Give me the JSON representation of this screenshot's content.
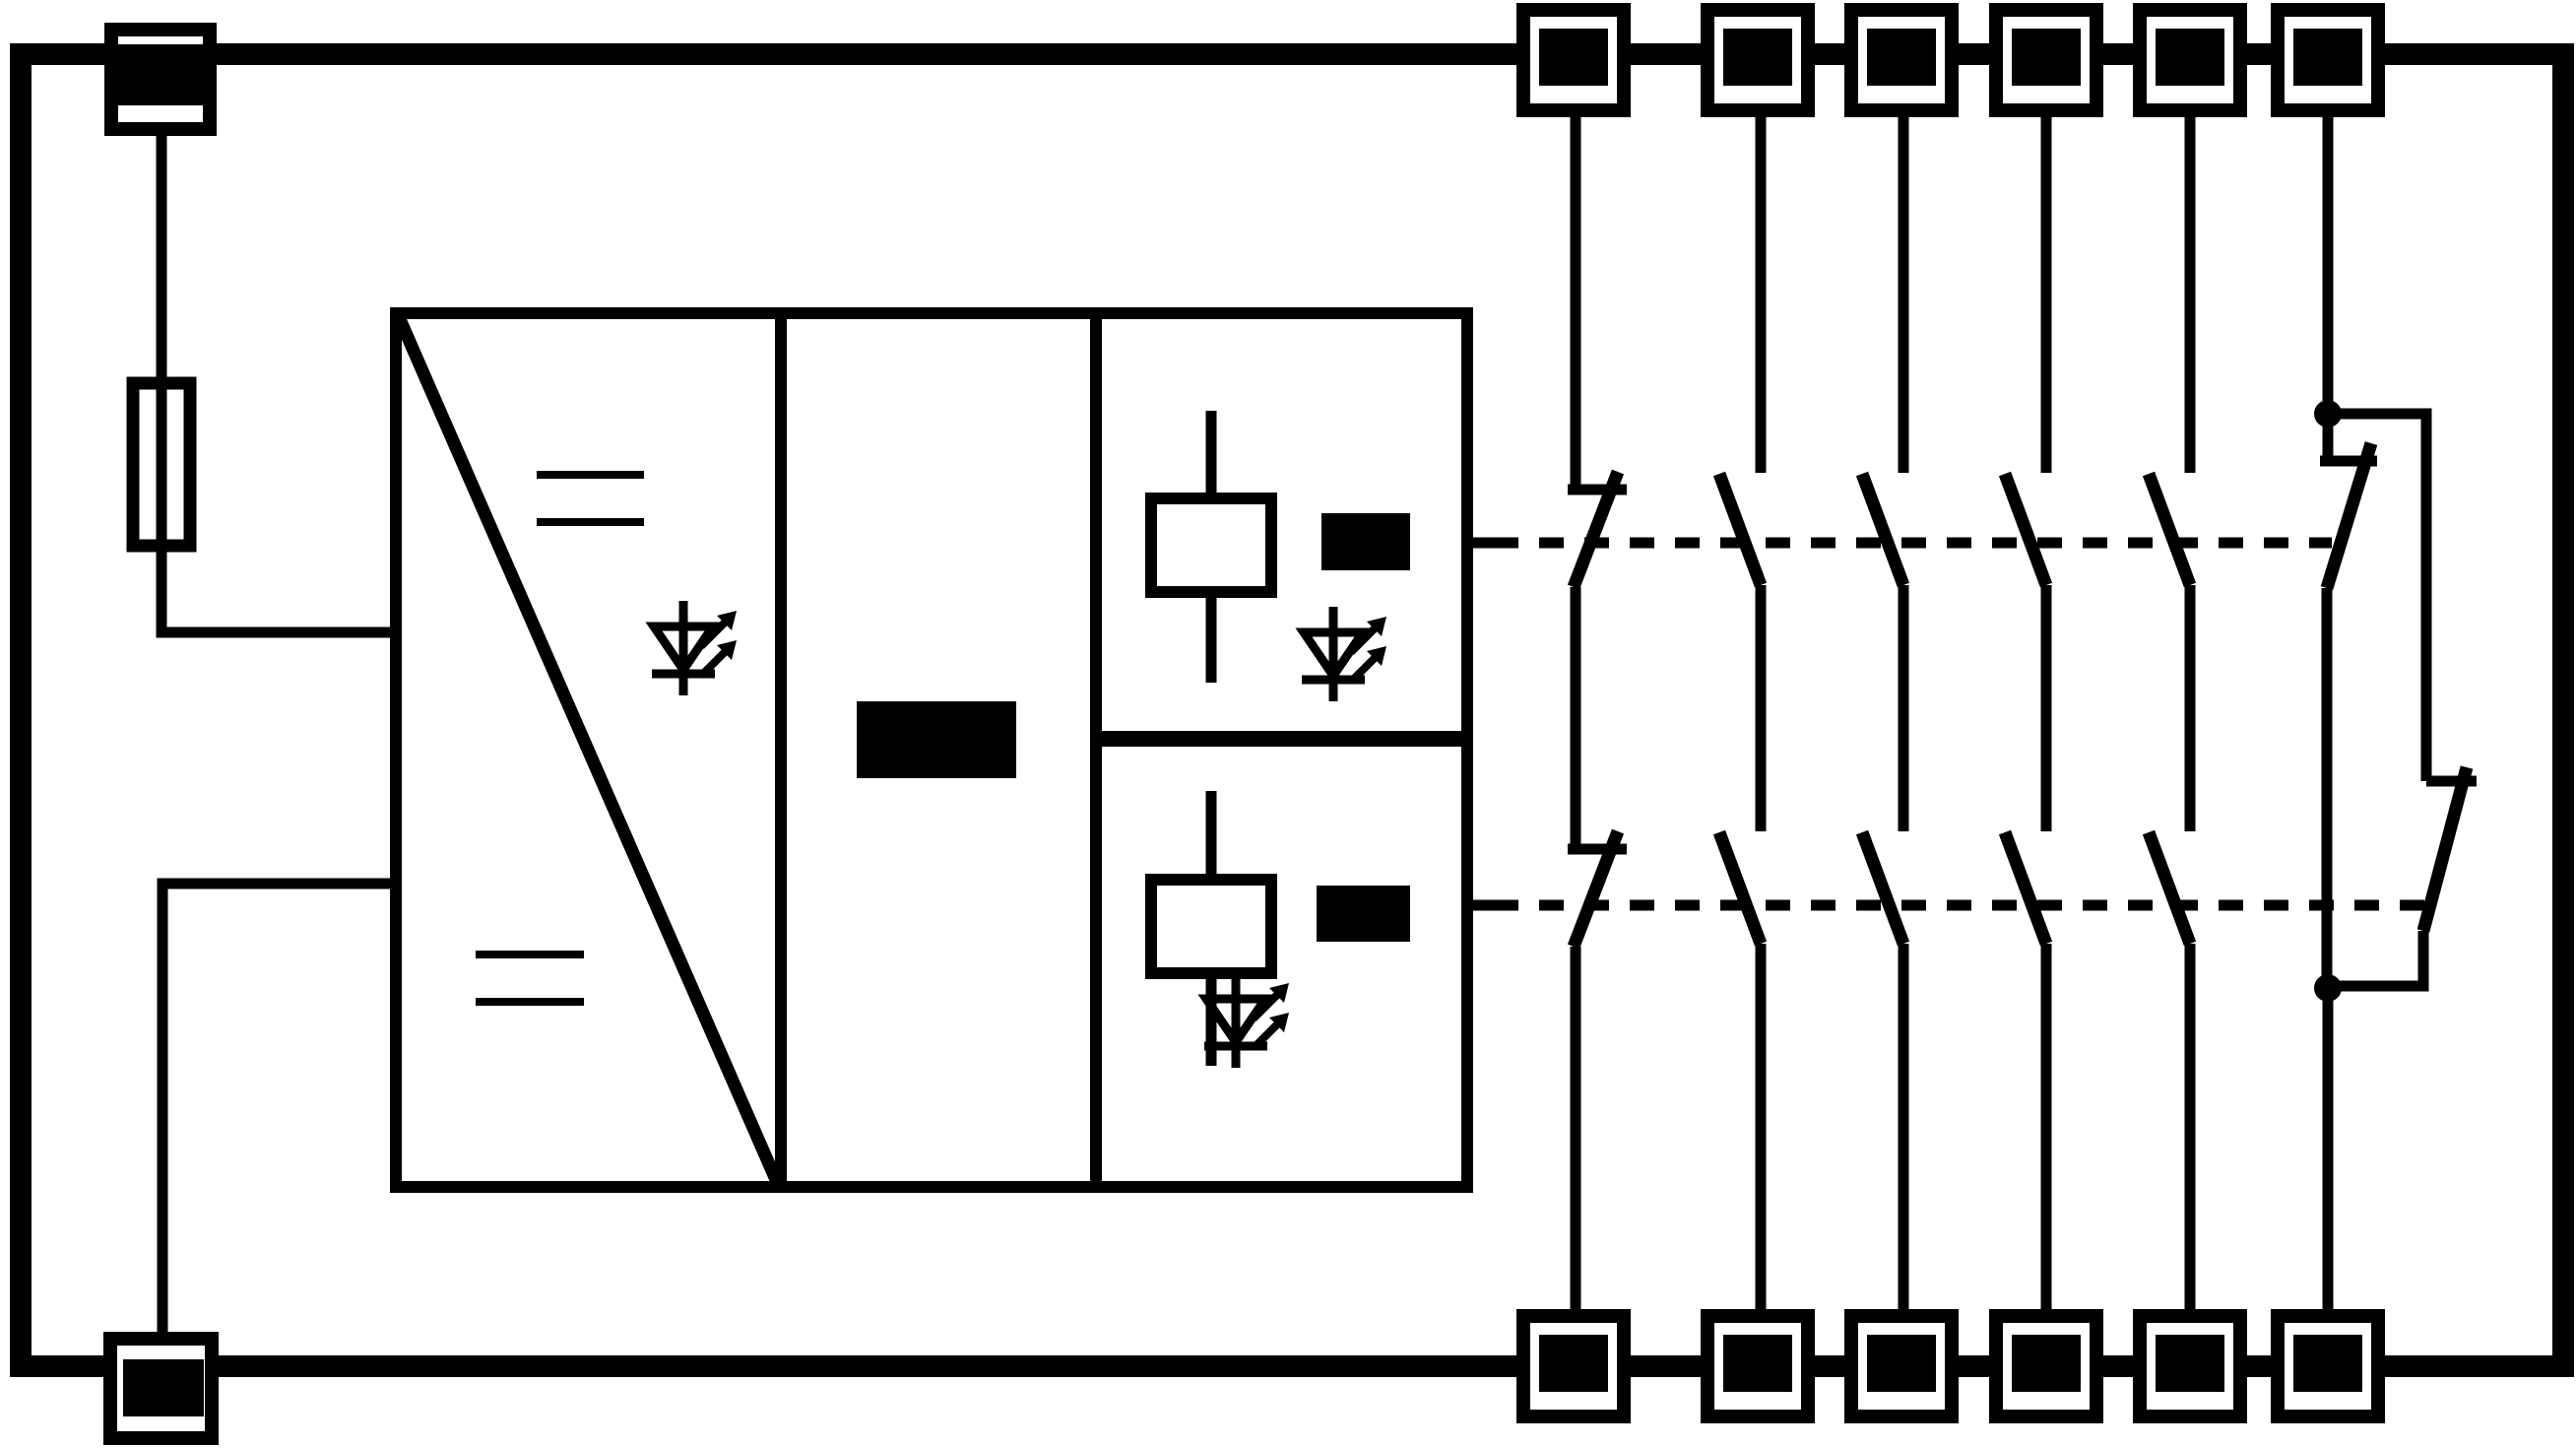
{
  "app": {
    "title": "Relay interface module wiring schematic"
  },
  "colors": {
    "ink": "#000000",
    "paper": "#ffffff"
  },
  "schematic": {
    "enclosure": "rectangular device outline",
    "input_side": {
      "top_left_terminal": "supply input terminal",
      "fuse": "internal fuse",
      "bottom_left_terminal": "supply return terminal"
    },
    "blocks": {
      "power_converter": {
        "diagonal_divider": true,
        "dc_symbols": 2,
        "led_indicator": 1
      },
      "control_block": {
        "label_redacted": true
      },
      "relay_channel_1": {
        "coil": 1,
        "label_redacted": true,
        "led_indicator": 1
      },
      "relay_channel_2": {
        "coil": 1,
        "label_redacted": true,
        "led_indicator": 1
      }
    },
    "linkage_lines": 2,
    "contact_field": {
      "top_terminals": 6,
      "bottom_terminals": 6,
      "columns": [
        {
          "index": 1,
          "type": "normally-closed",
          "contacts_in_series": 2
        },
        {
          "index": 2,
          "type": "normally-open",
          "contacts_in_series": 2
        },
        {
          "index": 3,
          "type": "normally-open",
          "contacts_in_series": 2
        },
        {
          "index": 4,
          "type": "normally-open",
          "contacts_in_series": 2
        },
        {
          "index": 5,
          "type": "normally-open",
          "contacts_in_series": 2
        },
        {
          "index": 6,
          "type": "changeover-parallel-nc",
          "contacts": 2,
          "junction_dots": 2
        }
      ]
    }
  }
}
